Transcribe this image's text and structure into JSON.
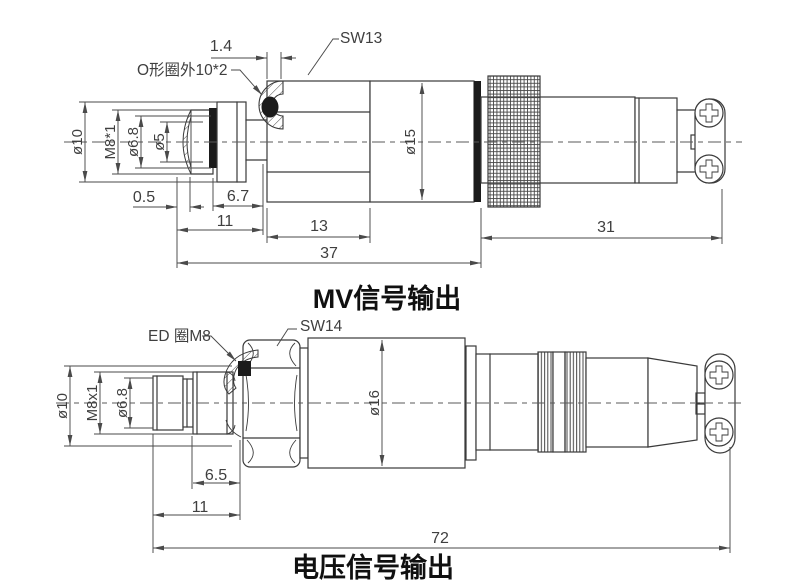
{
  "top": {
    "title": "MV信号输出",
    "callouts": {
      "wrench": "SW13",
      "oring": "O形圈外10*2"
    },
    "dia": {
      "outer": "ø10",
      "thread": "M8*1",
      "bore": "ø6.8",
      "inner": "ø5",
      "body": "ø15"
    },
    "dims": {
      "tip": "0.5",
      "oring_w": "1.4",
      "front_thread": "6.7",
      "front": "11",
      "hex": "13",
      "body": "37",
      "connector": "31"
    }
  },
  "bottom": {
    "title": "电压信号输出",
    "callouts": {
      "wrench": "SW14",
      "seal": "ED 圈M8"
    },
    "dia": {
      "outer": "ø10",
      "thread": "M8x1",
      "bore": "ø6.8",
      "body": "ø16"
    },
    "dims": {
      "front_thread": "6.5",
      "front": "11",
      "total": "72"
    }
  },
  "colors": {
    "line": "#3a3a3a",
    "dim_line": "#4a4a4a",
    "fill_black": "#1b1b1b",
    "background": "#ffffff"
  }
}
